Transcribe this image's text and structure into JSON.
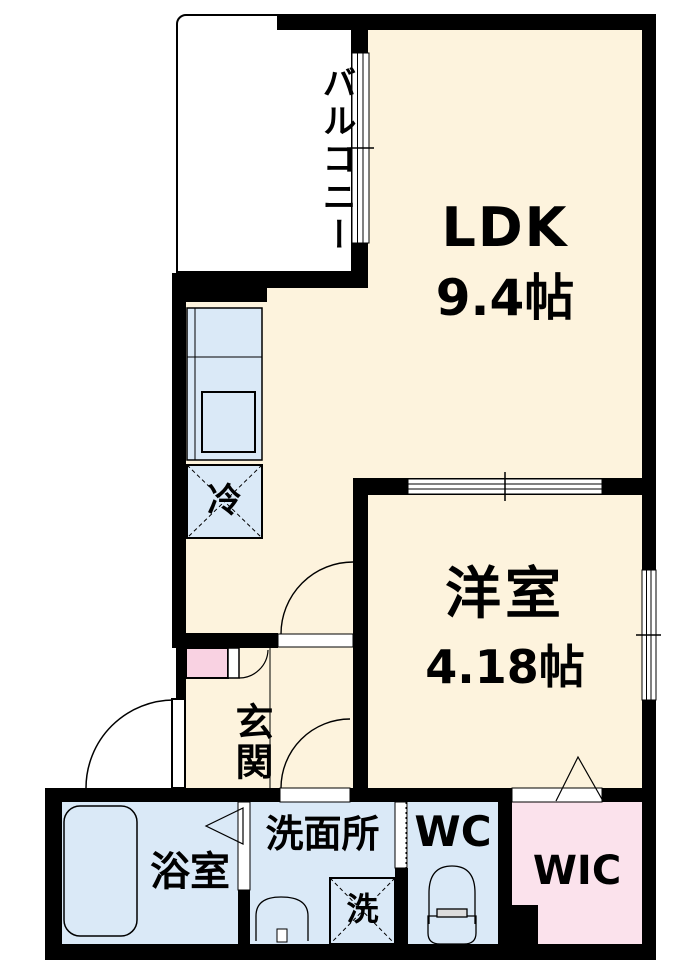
{
  "floorplan": {
    "rooms": {
      "balcony": {
        "label": "バルコニー"
      },
      "ldk": {
        "label": "LDK",
        "size": "9.4帖"
      },
      "western_room": {
        "label": "洋室",
        "size": "4.18帖"
      },
      "entrance": {
        "label": "玄関"
      },
      "bathroom": {
        "label": "浴室"
      },
      "washroom": {
        "label": "洗面所"
      },
      "toilet": {
        "label": "WC"
      },
      "walk_in_closet": {
        "label": "WIC"
      }
    },
    "fixtures": {
      "refrigerator": {
        "label": "冷"
      },
      "washing_machine": {
        "label": "洗"
      }
    },
    "colors": {
      "room_floor": "#FDF3DD",
      "wet_area_floor": "#DAE9F7",
      "closet_floor": "#FBE2EC",
      "shoe_cabinet": "#F9D2E2",
      "wall": "#000000",
      "background": "#FFFFFF"
    }
  }
}
